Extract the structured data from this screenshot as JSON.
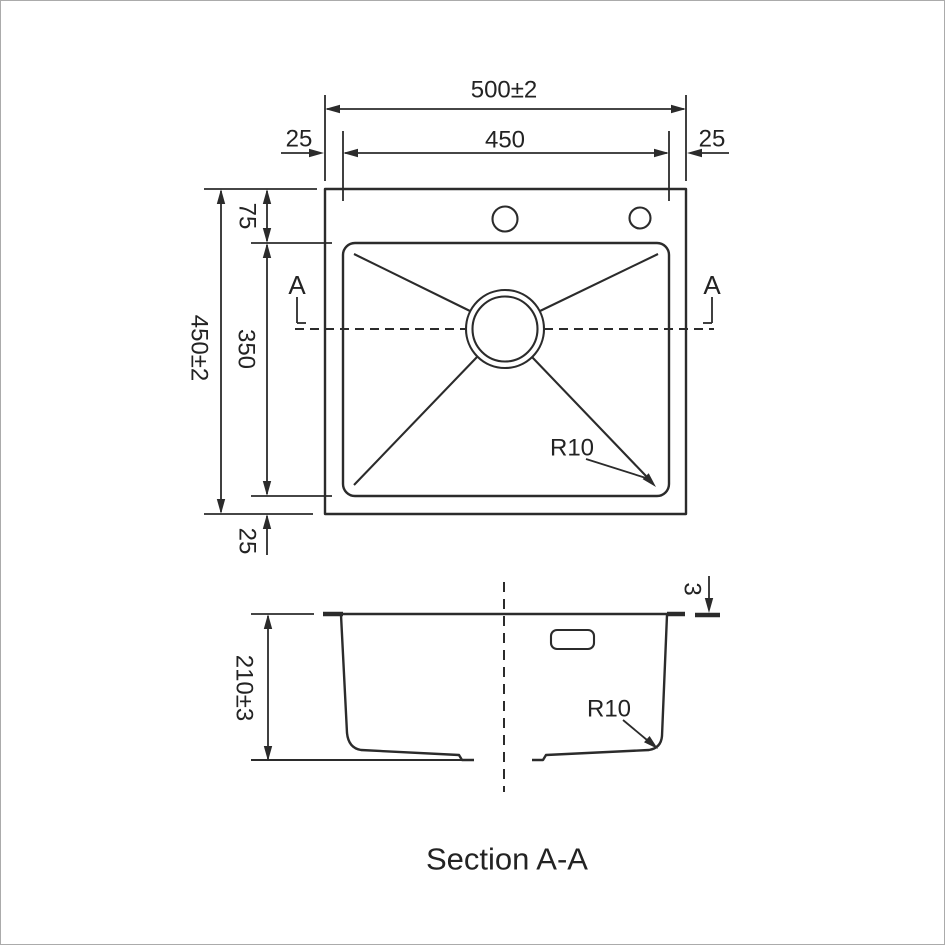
{
  "page": {
    "background_color": "#ffffff",
    "line_color": "#2b2b2b",
    "border_color": "#ababab"
  },
  "plan_view": {
    "dim_overall_width": "500±2",
    "dim_inner_width": "450",
    "dim_left_margin": "25",
    "dim_right_margin": "25",
    "dim_overall_height": "450±2",
    "dim_top_margin": "75",
    "dim_inner_height": "350",
    "dim_bottom_margin": "25",
    "corner_radius_label": "R10",
    "section_marker": "A"
  },
  "section_view": {
    "dim_depth": "210±3",
    "dim_rim_thickness": "3",
    "corner_radius_label": "R10",
    "title": "Section A-A"
  }
}
